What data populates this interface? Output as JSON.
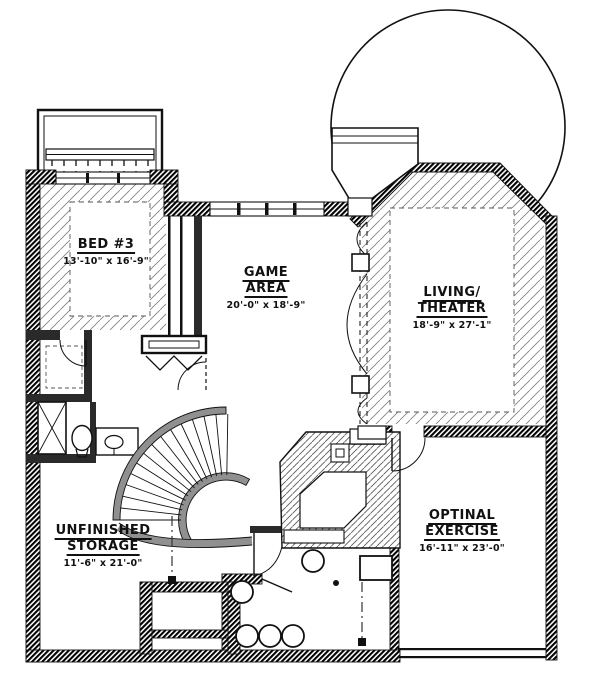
{
  "plan": {
    "rooms": {
      "bed3": {
        "line1": "BED #3",
        "line2": "",
        "dims": "13'-10\" x 16'-9\""
      },
      "game": {
        "line1": "GAME",
        "line2": "AREA",
        "dims": "20'-0\" x 18'-9\""
      },
      "living": {
        "line1": "LIVING/",
        "line2": "THEATER",
        "dims": "18'-9\" x 27'-1\""
      },
      "storage": {
        "line1": "UNFINISHED",
        "line2": "STORAGE",
        "dims": "11'-6\" x 21'-0\""
      },
      "exercise": {
        "line1": "OPTINAL",
        "line2": "EXERCISE",
        "dims": "16'-11\" x 23'-0\""
      }
    },
    "colors": {
      "ink": "#111111",
      "wall_gray": "#8f8f8f",
      "paper": "#ffffff"
    }
  }
}
